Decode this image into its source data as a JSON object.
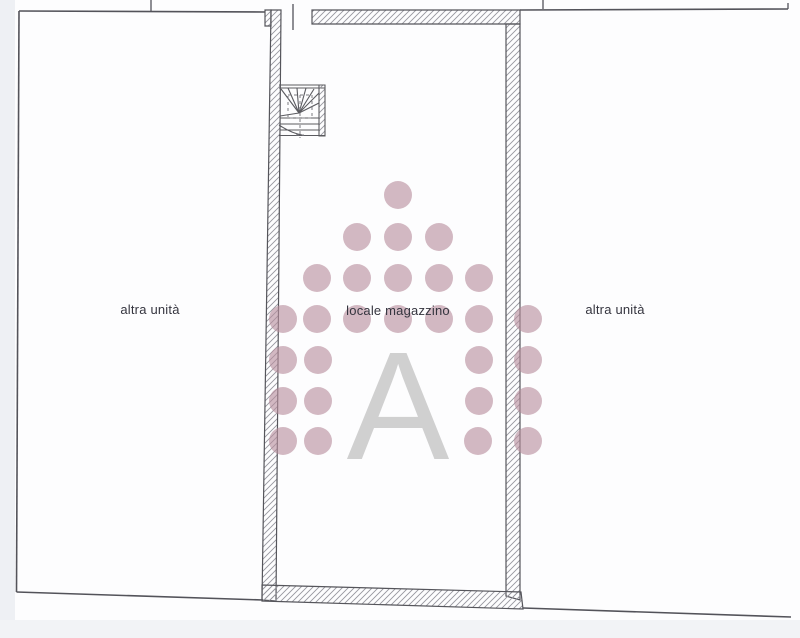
{
  "rooms": {
    "left": {
      "label": "altra unità"
    },
    "center": {
      "label": "locale magazzino"
    },
    "right": {
      "label": "altra unità"
    }
  },
  "watermark": {
    "letter": "A",
    "letter_color": "#c9c9c9",
    "circle_color": "#b88e9c",
    "circle_opacity": 0.62,
    "circle_radius": 14,
    "circles": [
      [
        398,
        195
      ],
      [
        357,
        237
      ],
      [
        398,
        237
      ],
      [
        439,
        237
      ],
      [
        317,
        278
      ],
      [
        357,
        278
      ],
      [
        398,
        278
      ],
      [
        439,
        278
      ],
      [
        479,
        278
      ],
      [
        283,
        319
      ],
      [
        317,
        319
      ],
      [
        357,
        319
      ],
      [
        398,
        319
      ],
      [
        439,
        319
      ],
      [
        479,
        319
      ],
      [
        528,
        319
      ],
      [
        283,
        360
      ],
      [
        318,
        360
      ],
      [
        479,
        360
      ],
      [
        528,
        360
      ],
      [
        283,
        401
      ],
      [
        318,
        401
      ],
      [
        479,
        401
      ],
      [
        528,
        401
      ],
      [
        283,
        441
      ],
      [
        318,
        441
      ],
      [
        478,
        441
      ],
      [
        528,
        441
      ]
    ]
  }
}
